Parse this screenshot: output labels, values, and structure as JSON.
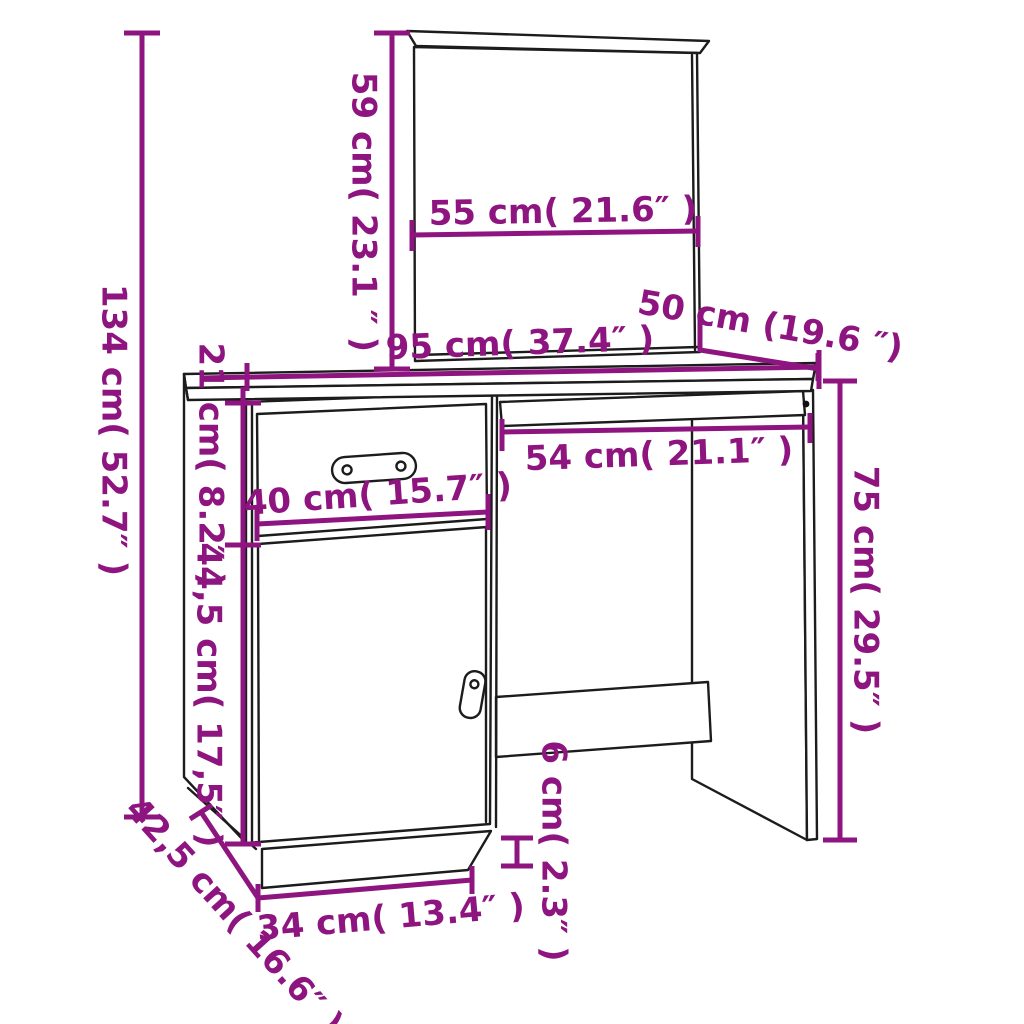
{
  "diagram": {
    "subject": "dressing-table-with-mirror-line-drawing",
    "style": "technical-dimension-diagram"
  },
  "colors": {
    "dimension": "#8E1480",
    "outline": "#1c1c1c",
    "knob": "#111111",
    "background": "#ffffff"
  },
  "dimensions": [
    {
      "id": "mirror-height",
      "label": "59 cm( 23.1 ″ )",
      "value_cm": 59,
      "value_in": 23.1
    },
    {
      "id": "mirror-width",
      "label": "55 cm( 21.6″ )",
      "value_cm": 55,
      "value_in": 21.6
    },
    {
      "id": "total-height",
      "label": "134 cm( 52.7″ )",
      "value_cm": 134,
      "value_in": 52.7
    },
    {
      "id": "desktop-width",
      "label": "95 cm( 37.4″ )",
      "value_cm": 95,
      "value_in": 37.4
    },
    {
      "id": "desktop-depth",
      "label": "50 cm (19.6 ″)",
      "value_cm": 50,
      "value_in": 19.6
    },
    {
      "id": "drawer-front-height",
      "label": "21 cm( 8.2″ )",
      "value_cm": 21,
      "value_in": 8.2
    },
    {
      "id": "door-front-height",
      "label": "44,5 cm( 17,5″ )",
      "value_cm": 44.5,
      "value_in": 17.5
    },
    {
      "id": "drawer-width",
      "label": "40 cm( 15.7″ )",
      "value_cm": 40,
      "value_in": 15.7
    },
    {
      "id": "kneehole-width",
      "label": "54 cm( 21.1″ )",
      "value_cm": 54,
      "value_in": 21.1
    },
    {
      "id": "desk-side-height",
      "label": "75 cm( 29.5″ )",
      "value_cm": 75,
      "value_in": 29.5
    },
    {
      "id": "plinth-height",
      "label": "6 cm( 2.3″ )",
      "value_cm": 6,
      "value_in": 2.3
    },
    {
      "id": "plinth-front-width",
      "label": "34 cm( 13.4″ )",
      "value_cm": 34,
      "value_in": 13.4
    },
    {
      "id": "cabinet-depth",
      "label": "42,5 cm( 16.6″ )",
      "value_cm": 42.5,
      "value_in": 16.6
    }
  ]
}
